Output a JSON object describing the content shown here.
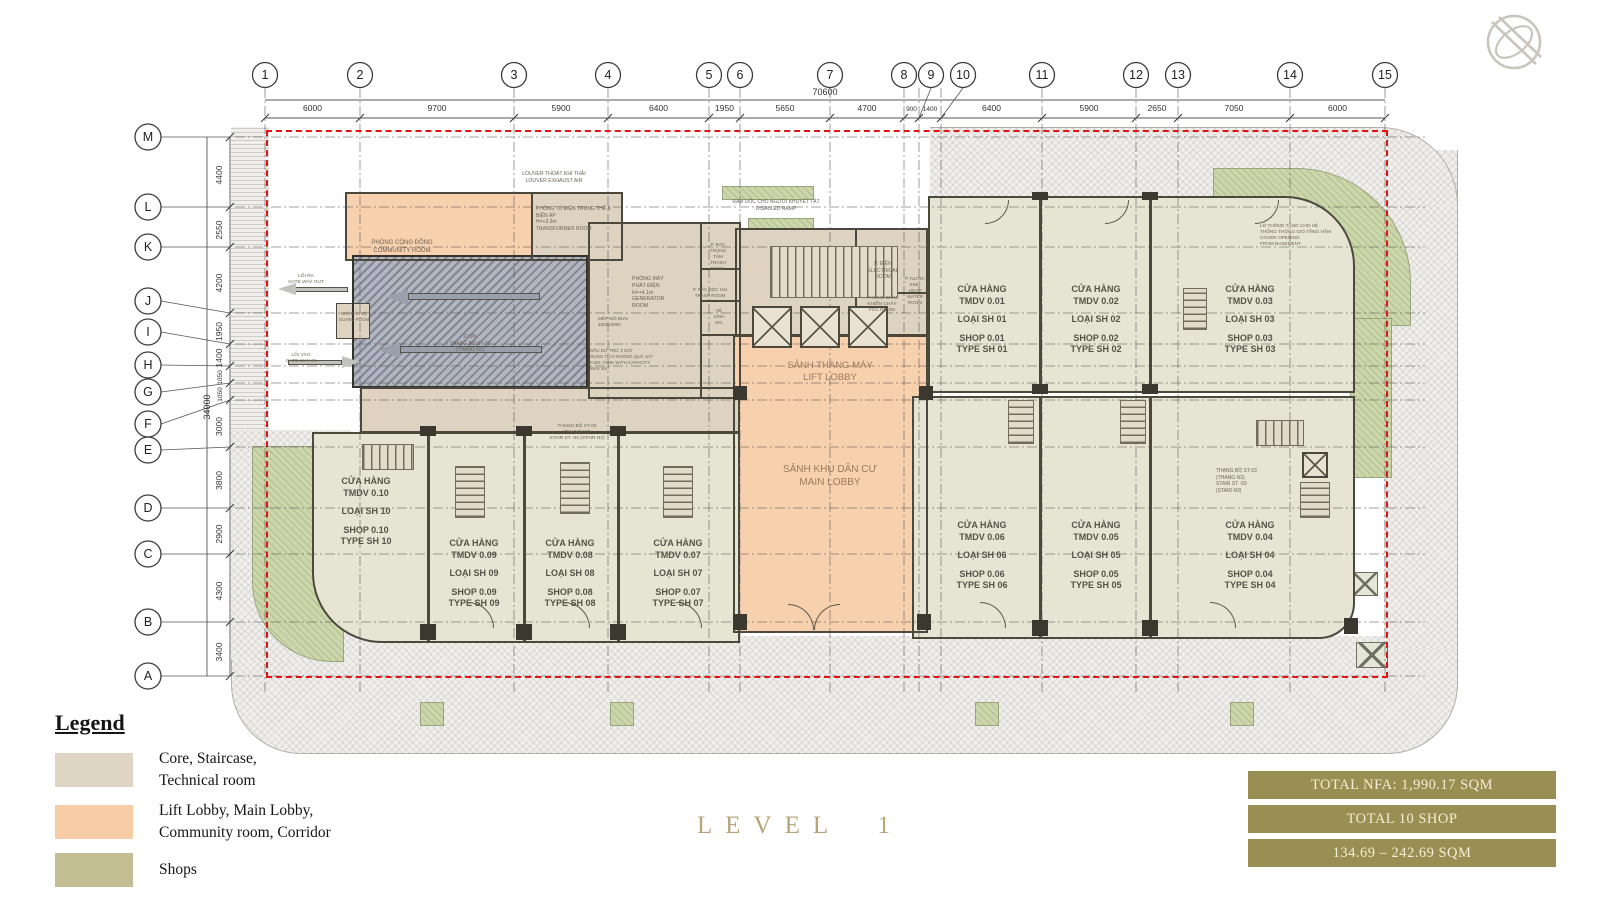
{
  "title": {
    "level": "LEVEL 1"
  },
  "grid": {
    "columns": [
      "1",
      "2",
      "3",
      "4",
      "5",
      "6",
      "7",
      "8",
      "9",
      "10",
      "11",
      "12",
      "13",
      "14",
      "15"
    ],
    "col_dims": [
      "6000",
      "9700",
      "5900",
      "6400",
      "1950",
      "5650",
      "4700",
      "900",
      "1400",
      "6400",
      "5900",
      "2650",
      "7050",
      "6000"
    ],
    "total_width": "70600",
    "rows": [
      "M",
      "L",
      "K",
      "J",
      "I",
      "H",
      "G",
      "F",
      "E",
      "D",
      "C",
      "B",
      "A"
    ],
    "row_dims": [
      "4400",
      "2550",
      "4200",
      "1950",
      "1400",
      "1050",
      "1050",
      "3000",
      "3800",
      "2900",
      "4300",
      "3400"
    ],
    "total_height": "34000"
  },
  "rooms": {
    "louver": {
      "lines": [
        "LOUVER THOÁT KHÍ THẢI",
        "LOUVER EXHAUST AIR"
      ]
    },
    "community": {
      "lines": [
        "PHÒNG CỘNG ĐỒNG",
        "COMMUNITY ROOM"
      ]
    },
    "transformer": {
      "lines": [
        "PHÒNG TỦ ĐIỆN TRUNG THẾ &",
        "BIẾN ÁP",
        "H=+3.3m",
        "TRANSFORMER ROOM"
      ]
    },
    "generator": {
      "lines": [
        "PHÒNG MÁY",
        "PHÁT ĐIỆN",
        "H=+4.1m",
        "GENERATOR",
        "ROOM"
      ]
    },
    "trash_central": {
      "lines": [
        "P. RÁC",
        "TRUNG",
        "TÂM",
        "TRASH",
        "ROOM"
      ]
    },
    "trash_hazard": {
      "lines": [
        "P. RÁC ĐỘC HẠI",
        "TRASH ROOM"
      ]
    },
    "wc": {
      "lines": [
        "VỆ",
        "SINH",
        "WC"
      ]
    },
    "disabled_ramp": {
      "lines": [
        "RAM DỐC CHO NGƯỜI KHUYẾT TẬT",
        "DISABLED RAMP"
      ]
    },
    "electrical": {
      "lines": [
        "P. ĐIỆN",
        "ELECTRICAL",
        "ROOM"
      ]
    },
    "fcc": {
      "lines": [
        "PHÒNG ĐIỀU",
        "KHIỂN CHÁY",
        "FCC ROOM"
      ]
    },
    "water": {
      "lines": [
        "P. NƯỚC",
        "SINH",
        "HOẠT",
        "WATER",
        "ROOM"
      ]
    },
    "lift_lobby": {
      "lines": [
        "SẢNH THANG MÁY",
        "LIFT LOBBY"
      ]
    },
    "main_lobby": {
      "lines": [
        "SẢNH KHU DÂN CƯ",
        "MAIN LOBBY"
      ]
    },
    "gate_out": {
      "lines": [
        "LỐI RA",
        "GATE WAY OUT"
      ]
    },
    "guard": {
      "lines": [
        "NHÀ BẢO VỆ",
        "GUARD ROOM"
      ]
    },
    "gate_in": {
      "lines": [
        "LỐI VÀO",
        "GATE WAY IN"
      ]
    },
    "stair_st02": {
      "lines": [
        "17.9%",
        "THANG BỘ ST-02",
        "(THANG N1)"
      ]
    },
    "stair_st04": {
      "lines": [
        "THANG BỘ ST-04",
        "(THANG N2)",
        "STAIR ST -04 (STAIR N2)"
      ]
    },
    "stair_st03": {
      "lines": [
        "THANG BỘ ST-03",
        "(THANG N3)",
        "STAIR ST -03",
        "(STAIR N3)"
      ]
    },
    "cover_opening": {
      "lines": [
        "LỖ THÔNG TẦNG CHO HỆ",
        "THỐNG THÔNG GIÓ TẦNG HẦM",
        "COVER OPENING",
        "FROM BASEMENT"
      ]
    },
    "fuel_tank": {
      "lines": [
        "DẦU DỰ TRỮ 3 GIỜ",
        "DUNG TÍCH KHÔNG QUÁ 1m³",
        "FUEL TANK WITH CAPACITY",
        "MAX 3m³"
      ]
    },
    "module": {
      "lines": [
        "MÉP MÔ ĐUN",
        "4800x3000"
      ]
    }
  },
  "shops": [
    {
      "l1": "CỬA HÀNG",
      "l2": "TMDV 0.01",
      "l3": "LOẠI SH 01",
      "l4": "SHOP 0.01",
      "l5": "TYPE SH 01"
    },
    {
      "l1": "CỬA HÀNG",
      "l2": "TMDV 0.02",
      "l3": "LOẠI SH 02",
      "l4": "SHOP 0.02",
      "l5": "TYPE SH 02"
    },
    {
      "l1": "CỬA HÀNG",
      "l2": "TMDV 0.03",
      "l3": "LOẠI SH 03",
      "l4": "SHOP 0.03",
      "l5": "TYPE SH 03"
    },
    {
      "l1": "CỬA HÀNG",
      "l2": "TMDV 0.04",
      "l3": "LOẠI SH 04",
      "l4": "SHOP 0.04",
      "l5": "TYPE SH 04"
    },
    {
      "l1": "CỬA HÀNG",
      "l2": "TMDV 0.05",
      "l3": "LOẠI SH 05",
      "l4": "SHOP 0.05",
      "l5": "TYPE SH 05"
    },
    {
      "l1": "CỬA HÀNG",
      "l2": "TMDV 0.06",
      "l3": "LOẠI SH 06",
      "l4": "SHOP 0.06",
      "l5": "TYPE SH 06"
    },
    {
      "l1": "CỬA HÀNG",
      "l2": "TMDV 0.07",
      "l3": "LOẠI SH 07",
      "l4": "SHOP 0.07",
      "l5": "TYPE SH 07"
    },
    {
      "l1": "CỬA HÀNG",
      "l2": "TMDV 0.08",
      "l3": "LOẠI SH 08",
      "l4": "SHOP 0.08",
      "l5": "TYPE SH 08"
    },
    {
      "l1": "CỬA HÀNG",
      "l2": "TMDV 0.09",
      "l3": "LOẠI SH 09",
      "l4": "SHOP 0.09",
      "l5": "TYPE SH 09"
    },
    {
      "l1": "CỬA HÀNG",
      "l2": "TMDV 0.10",
      "l3": "LOẠI SH 10",
      "l4": "SHOP 0.10",
      "l5": "TYPE SH 10"
    }
  ],
  "legend": {
    "heading": "Legend",
    "items": [
      {
        "label": "Core, Staircase,\nTechnical room",
        "color": "#ded5c4"
      },
      {
        "label": "Lift Lobby, Main Lobby,\nCommunity room, Corridor",
        "color": "#f7cda8"
      },
      {
        "label": "Shops",
        "color": "#c2bd92"
      }
    ]
  },
  "summary": {
    "bg": "#9a8f52",
    "rows": [
      "TOTAL NFA: 1,990.17 SQM",
      "TOTAL 10 SHOP",
      "134.69 – 242.69 SQM"
    ]
  },
  "colors": {
    "boundary_red": "#e01414",
    "title_gold": "#b5a57b"
  }
}
